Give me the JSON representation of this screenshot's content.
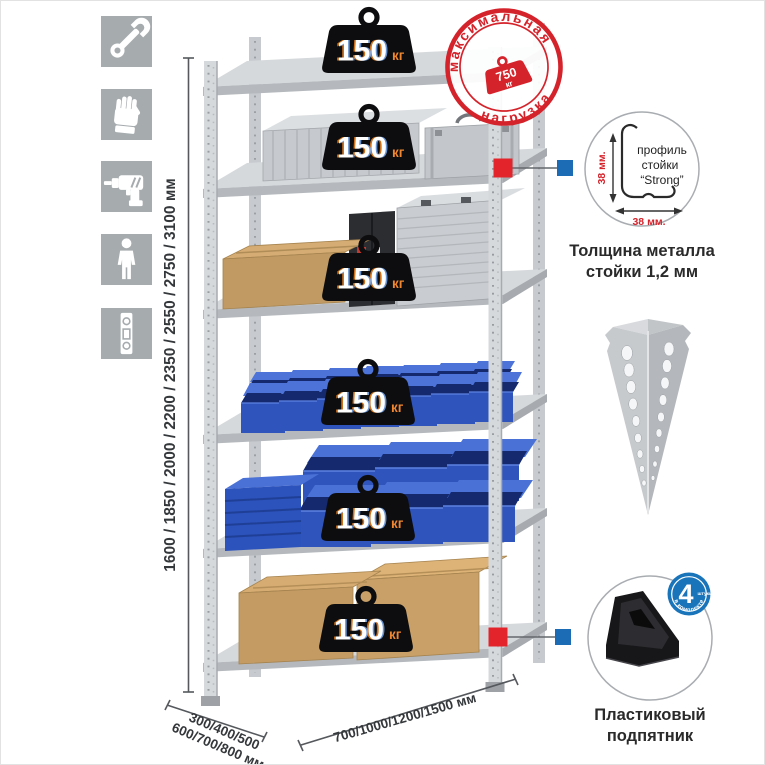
{
  "illustration": {
    "height_dims": "1600 / 1850 / 2000 / 2200 / 2350 / 2550 / 2750 / 3100 мм",
    "depth_dims_line1": "300/400/500",
    "depth_dims_line2": "600/700/800 мм",
    "width_dims": "700/1000/1200/1500 мм"
  },
  "rack": {
    "weights": [
      {
        "value": "150",
        "unit": "кг"
      },
      {
        "value": "150",
        "unit": "кг"
      },
      {
        "value": "150",
        "unit": "кг"
      },
      {
        "value": "150",
        "unit": "кг"
      },
      {
        "value": "150",
        "unit": "кг"
      },
      {
        "value": "150",
        "unit": "кг"
      }
    ]
  },
  "stamp": {
    "arc_top": "максимальная",
    "arc_bottom": "нагрузка",
    "weight_value": "750",
    "weight_unit": "кг",
    "color": "#d5232b"
  },
  "profile_detail": {
    "label_line1": "профиль",
    "label_line2": "стойки",
    "label_line3": "“Strong”",
    "dim_height": "38 мм.",
    "dim_width": "38 мм.",
    "caption_line1": "Толщина металла",
    "caption_line2": "стойки 1,2 мм"
  },
  "foot_detail": {
    "badge_value": "4",
    "badge_unit": "штуки",
    "badge_arc": "в комплекте",
    "caption_line1": "Пластиковый",
    "caption_line2": "подпятник"
  },
  "colors": {
    "accent_red": "#e3252b",
    "accent_blue": "#1b6cb5",
    "bin_blue": "#2f55bd",
    "tile_gray": "#a6abae"
  },
  "icons": [
    {
      "name": "wrench-icon"
    },
    {
      "name": "gloves-icon"
    },
    {
      "name": "drill-icon"
    },
    {
      "name": "person-icon"
    },
    {
      "name": "level-icon"
    }
  ]
}
